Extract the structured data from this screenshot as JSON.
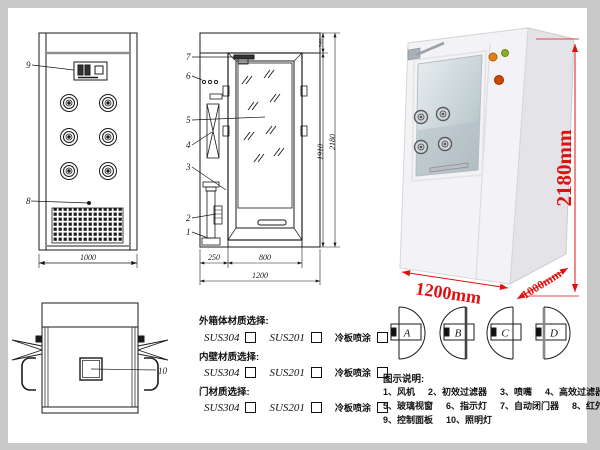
{
  "colors": {
    "dim_red": "#e01010",
    "line": "#1a1a1a"
  },
  "front_view": {
    "callout_9": "9",
    "callout_8": "8",
    "width_dim": "1000"
  },
  "side_view": {
    "callouts": [
      "7",
      "6",
      "5",
      "4",
      "3",
      "2",
      "1"
    ],
    "dim_top": "260",
    "dim_door_h": "1910",
    "dim_total_h": "2180",
    "dim_left": "250",
    "dim_door_w": "800",
    "dim_total_w": "1200"
  },
  "top_view": {
    "callout_10": "10"
  },
  "photo": {
    "dim_height": "2180mm",
    "dim_width": "1200mm",
    "dim_depth": "1000mm"
  },
  "materials": {
    "sections": [
      {
        "title": "外箱体材质选择:",
        "options": [
          "SUS304",
          "SUS201",
          "冷板喷涂"
        ]
      },
      {
        "title": "内壁材质选择:",
        "options": [
          "SUS304",
          "SUS201",
          "冷板喷涂"
        ]
      },
      {
        "title": "门材质选择:",
        "options": [
          "SUS304",
          "SUS201",
          "冷板喷涂"
        ]
      }
    ]
  },
  "door_options": {
    "labels": [
      "A",
      "B",
      "C",
      "D"
    ]
  },
  "legend": {
    "title": "图示说明:",
    "rows": [
      [
        "1、风机",
        "2、初效过滤器",
        "3、喷嘴",
        "4、高效过滤器"
      ],
      [
        "5、玻璃视窗",
        "6、指示灯",
        "7、自动闭门器",
        "8、红外线感应器"
      ],
      [
        "9、控制面板",
        "10、照明灯"
      ]
    ]
  }
}
